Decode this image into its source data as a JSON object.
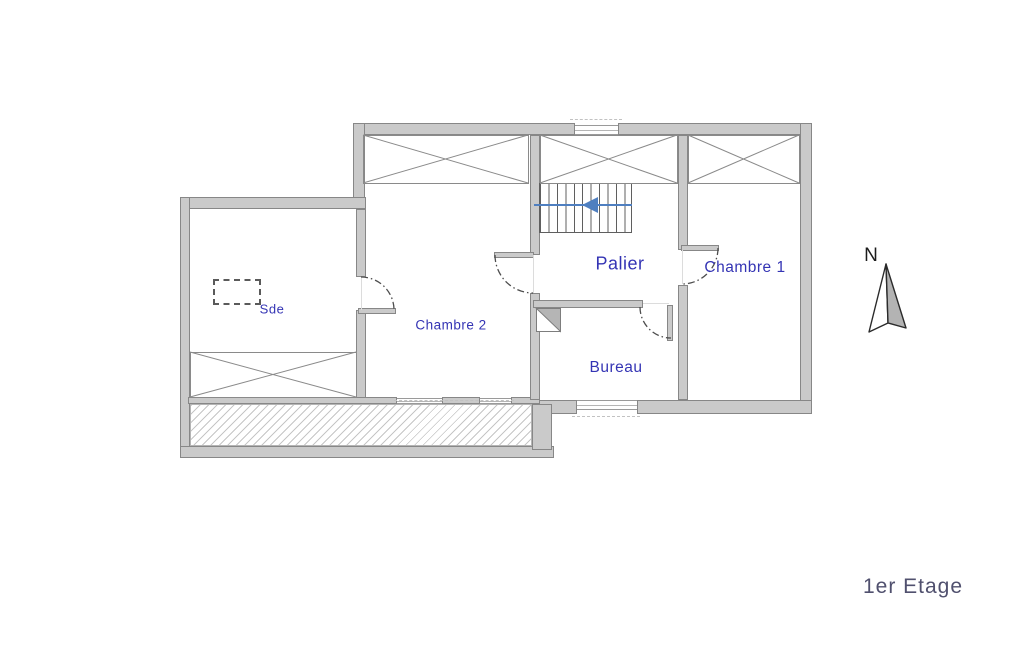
{
  "floor_label": "1er Etage",
  "compass": {
    "label": "N"
  },
  "rooms": {
    "sde": "Sde",
    "chambre2": "Chambre 2",
    "palier": "Palier",
    "chambre1": "Chambre 1",
    "bureau": "Bureau"
  },
  "stairs": {
    "direction": "down-left"
  },
  "colors": {
    "wall_fill": "#cacaca",
    "wall_edge": "#878787",
    "label_blue": "#3434b4",
    "arrow_blue": "#4f7fc0",
    "floor_gray": "#50506e",
    "compass_fill": "#b3b3b3",
    "cross_line": "#8a8a8a"
  }
}
